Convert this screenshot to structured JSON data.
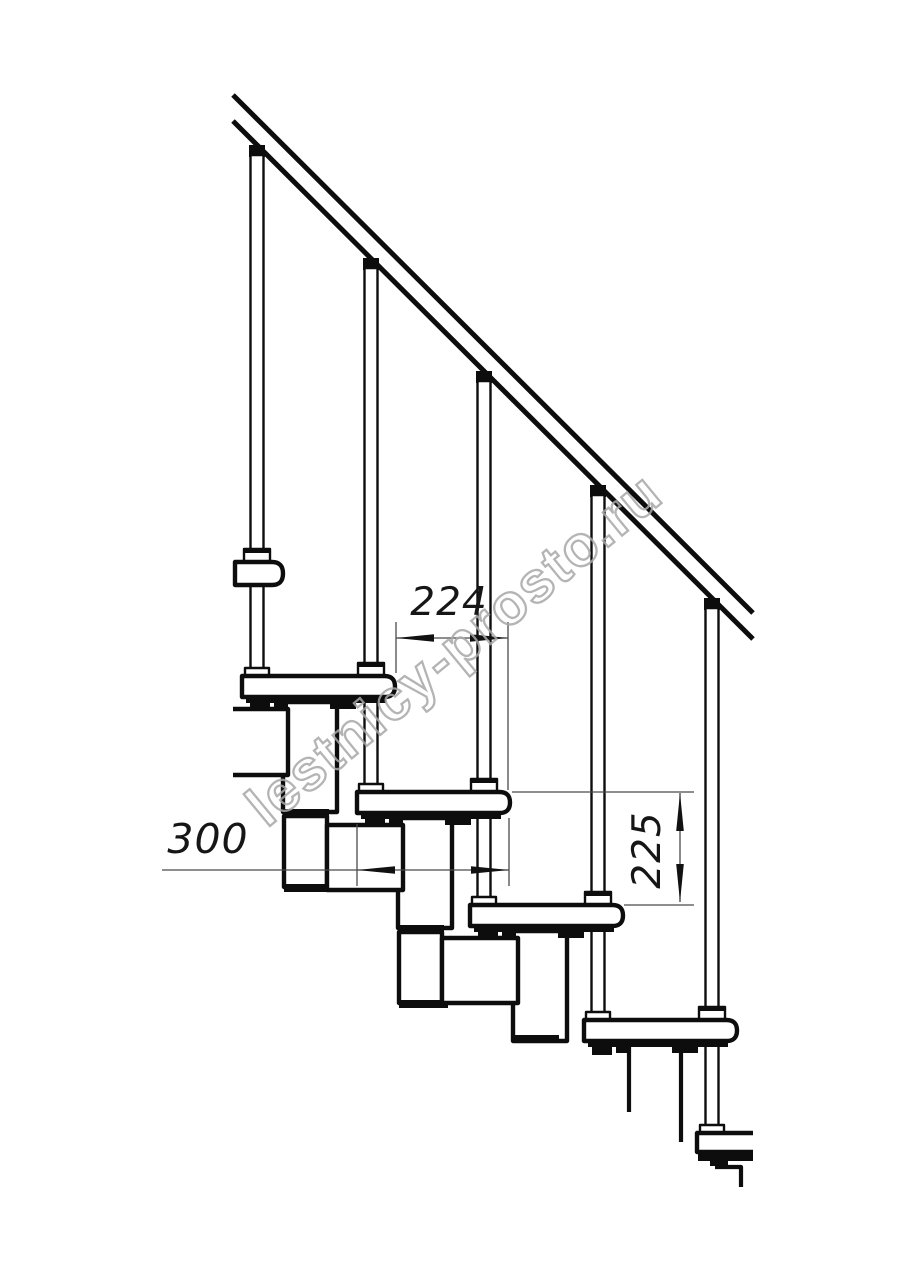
{
  "drawing": {
    "dimensions": {
      "step_going_mm": "224",
      "tread_depth_mm": "300",
      "riser_height_mm": "225"
    },
    "watermark": "lestnicy-prosto.ru",
    "colors": {
      "ink": "#0d0d0d",
      "dimension_line": "#4a4a4a",
      "dimension_text": "#161616",
      "watermark": "#a8a8a8",
      "background": "#ffffff"
    }
  }
}
